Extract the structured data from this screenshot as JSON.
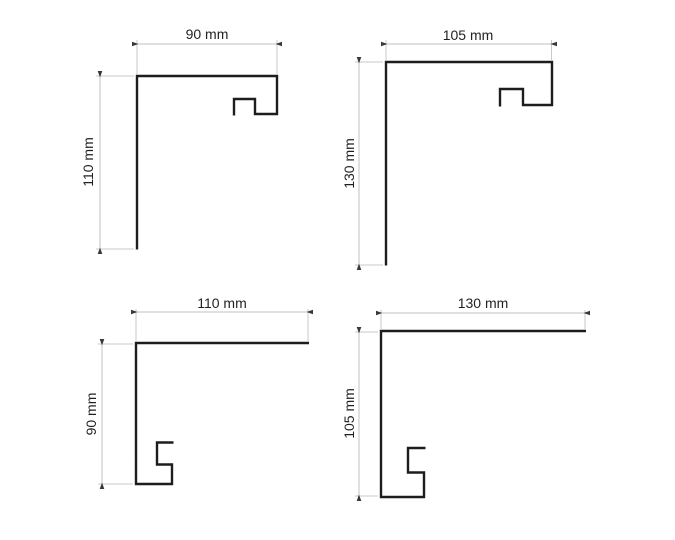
{
  "diagram": {
    "type": "technical-drawing",
    "description": "Four aluminium window-sill end-cap profile cross sections with dimension annotations",
    "background": "#ffffff",
    "profile_line_color": "#1d1d1b",
    "dimension_line_color": "#c2c2c2",
    "arrow_color": "#383838",
    "text_color": "#231f20",
    "profiles": [
      {
        "position": "top-left",
        "width_label": "90 mm",
        "height_label": "110 mm",
        "width_mm": 90,
        "height_mm": 110,
        "hook": "top-right"
      },
      {
        "position": "top-right",
        "width_label": "105 mm",
        "height_label": "130 mm",
        "width_mm": 105,
        "height_mm": 130,
        "hook": "top-right"
      },
      {
        "position": "bottom-left",
        "width_label": "110 mm",
        "height_label": "90 mm",
        "width_mm": 110,
        "height_mm": 90,
        "hook": "bottom-left"
      },
      {
        "position": "bottom-right",
        "width_label": "130 mm",
        "height_label": "105 mm",
        "width_mm": 130,
        "height_mm": 105,
        "hook": "bottom-left"
      }
    ]
  }
}
